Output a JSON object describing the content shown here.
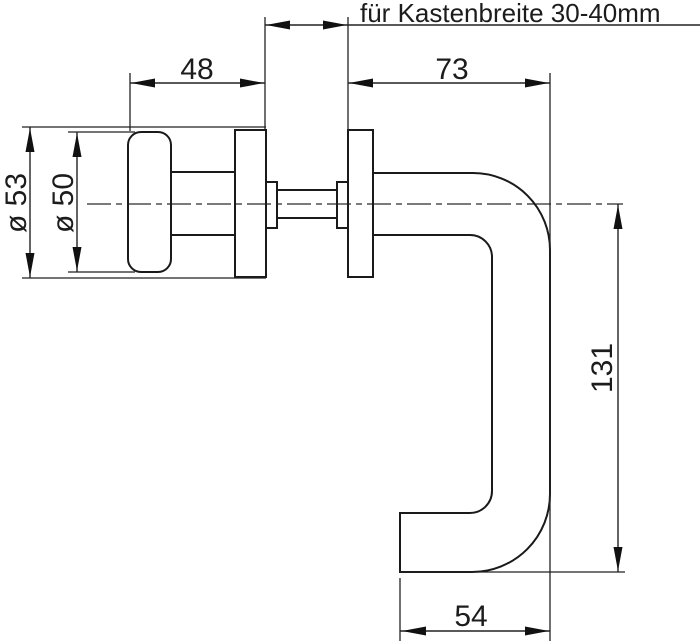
{
  "drawing": {
    "title": "für Kastenbreite 30-40mm",
    "dimensions": {
      "kastenbreite_note": "für Kastenbreite 30-40mm",
      "knob_side_depth": "48",
      "lever_side_depth": "73",
      "rose_diameter": "ø 53",
      "knob_diameter": "ø 50",
      "lever_length": "131",
      "lever_grip_width": "54"
    },
    "colors": {
      "line": "#1a1a1a",
      "background": "#ffffff"
    }
  }
}
